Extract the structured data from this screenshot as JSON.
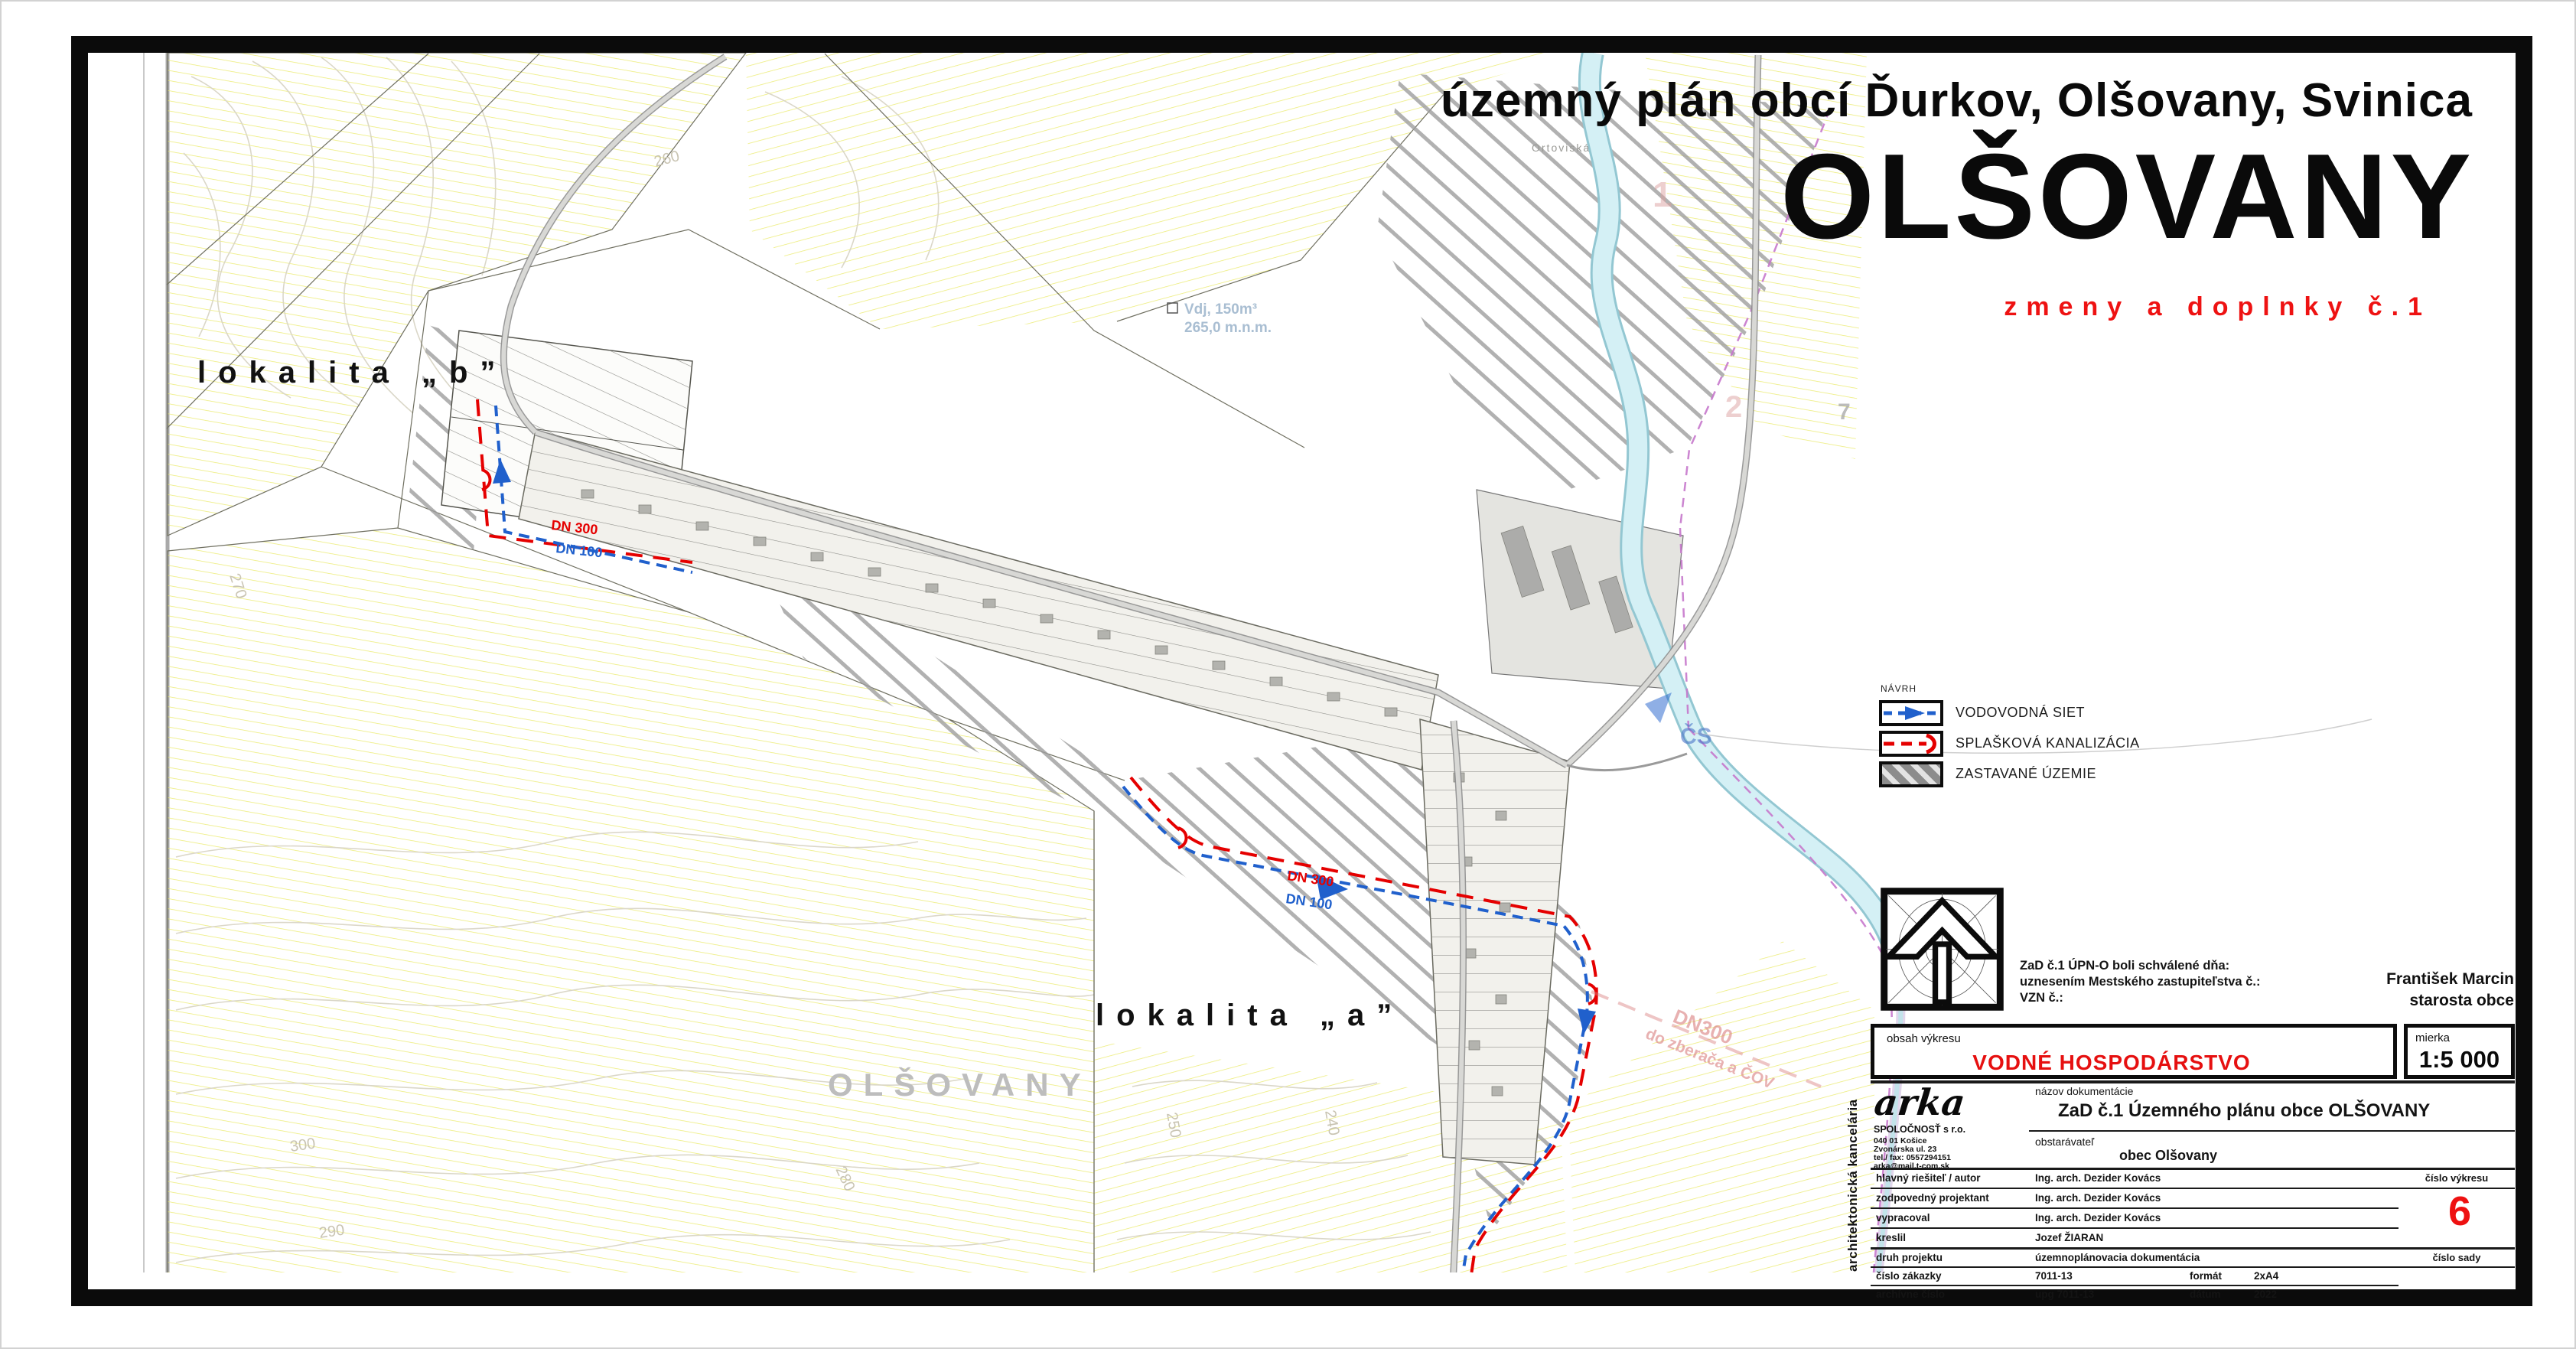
{
  "header": {
    "title_line": "územný plán obcí Ďurkov, Olšovany, Svinica",
    "title_main": "OLŠOVANY",
    "title_sub": "zmeny a doplnky č.1"
  },
  "legend": {
    "heading": "NÁVRH",
    "items": [
      {
        "label": "VODOVODNÁ SIET",
        "color": "#2060cc"
      },
      {
        "label": "SPLAŠKOVÁ KANALIZÁCIA",
        "color": "#e50000"
      },
      {
        "label": "ZASTAVANÉ ÚZEMIE",
        "color": "#8c8c8c"
      }
    ]
  },
  "approval": {
    "line1": "ZaD č.1 ÚPN-O boli schválené dňa:",
    "line2": "uznesením Mestského zastupiteľstva č.:",
    "line3": "VZN č.:"
  },
  "mayor": {
    "name": "František Marcin",
    "role": "starosta obce"
  },
  "content_box": {
    "label": "obsah výkresu",
    "value": "VODNÉ HOSPODÁRSTVO"
  },
  "scale_box": {
    "label": "mierka",
    "value": "1:5 000"
  },
  "firm": {
    "vertical": "architektonická kancelária",
    "logo": "arka",
    "line1": "SPOLOČNOSŤ s r.o.",
    "line2": "040 01  Košice",
    "line3": "Zvonárska ul. 23",
    "line4": "tel./ fax:  0557294151",
    "line5": "arka@mail.t-com.sk"
  },
  "titleblock": {
    "doc_label": "názov dokumentácie",
    "doc_value": "ZaD č.1  Územného plánu obce OLŠOVANY",
    "client_label": "obstarávateľ",
    "client_value": "obec Olšovany",
    "rows": [
      {
        "label": "hlavný riešiteľ / autor",
        "value": "Ing. arch. Dezider Kovács"
      },
      {
        "label": "zodpovedný projektant",
        "value": "Ing. arch. Dezider Kovács"
      },
      {
        "label": "vypracoval",
        "value": "Ing. arch. Dezider Kovács"
      },
      {
        "label": "kreslil",
        "value": "Jozef ŽIARAN"
      }
    ],
    "drawing_no_label": "číslo výkresu",
    "drawing_no": "6",
    "set_no_label": "číslo sady",
    "meta_rows": [
      {
        "label": "druh projektu",
        "value": "územnoplánovacia dokumentácia",
        "k2": "",
        "v2": ""
      },
      {
        "label": "číslo zákazky",
        "value": "7011-13",
        "k2": "formát",
        "v2": "2xA4"
      },
      {
        "label": "archívne číslo",
        "value": "upg 7011-13",
        "k2": "dátum",
        "v2": "2022"
      }
    ]
  },
  "map": {
    "lokalita_b": "lokalita „b”",
    "lokalita_a": "lokalita „a”",
    "watermark": "OLŠOVANY",
    "ortoviska": "Ortoviská",
    "reservoir1": "Vdj, 150m³",
    "reservoir2": "265,0 m.n.m.",
    "cs": "ČS",
    "dn300": "DN 300",
    "dn100": "DN 100",
    "sewer_note1": "DN300",
    "sewer_note2": "do zberača a ČOV",
    "zones": {
      "one": "1",
      "two": "2",
      "seven": "7"
    },
    "contour_labels": {
      "c240": "240",
      "c250": "250",
      "c260": "260",
      "c270": "270",
      "c280": "280",
      "c290": "290",
      "c300": "300"
    }
  }
}
